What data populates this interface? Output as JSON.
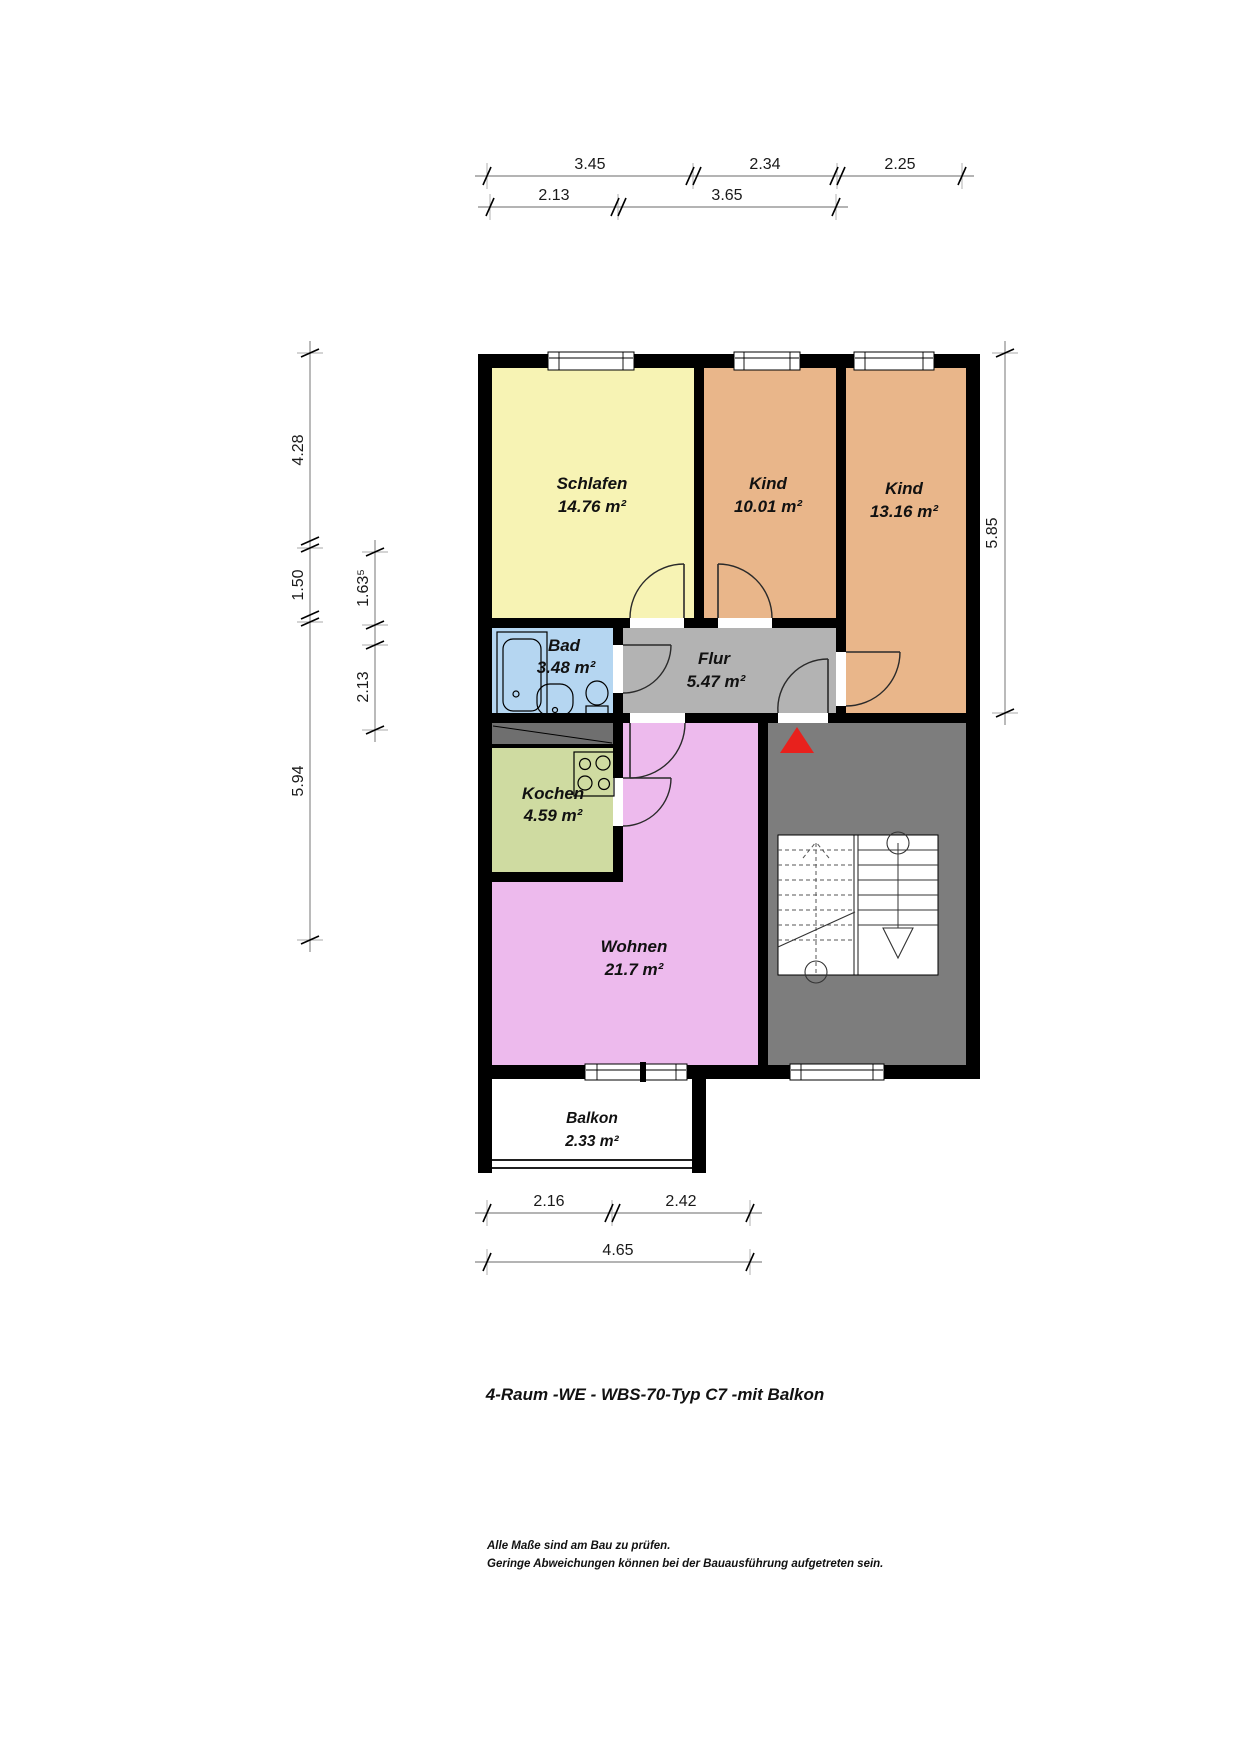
{
  "title": "4-Raum -WE - WBS-70-Typ C7 -mit Balkon",
  "notes": {
    "line1": "Alle Maße sind am Bau zu prüfen.",
    "line2": "Geringe Abweichungen können bei der Bauausführung aufgetreten sein."
  },
  "rooms": [
    {
      "id": "schlafen",
      "name": "Schlafen",
      "area": "14.76 m²",
      "color": "#f7f3b4"
    },
    {
      "id": "kind-1",
      "name": "Kind",
      "area": "10.01 m²",
      "color": "#e9b68a"
    },
    {
      "id": "kind-2",
      "name": "Kind",
      "area": "13.16 m²",
      "color": "#e9b68a"
    },
    {
      "id": "bad",
      "name": "Bad",
      "area": "3.48 m²",
      "color": "#b5d6f1"
    },
    {
      "id": "flur",
      "name": "Flur",
      "area": "5.47 m²",
      "color": "#b3b3b3"
    },
    {
      "id": "kochen",
      "name": "Kochen",
      "area": "4.59 m²",
      "color": "#cfdba1"
    },
    {
      "id": "wohnen",
      "name": "Wohnen",
      "area": "21.7 m²",
      "color": "#edbaed"
    },
    {
      "id": "balkon",
      "name": "Balkon",
      "area": "2.33 m²",
      "color": "#ffffff"
    }
  ],
  "dimensions": {
    "top_row1": [
      "3.45",
      "2.34",
      "2.25"
    ],
    "top_row2": [
      "2.13",
      "3.65"
    ],
    "left_outer": [
      "4.28",
      "1.50",
      "5.94"
    ],
    "left_inner": [
      "1.63⁵",
      "2.13"
    ],
    "right": [
      "5.85"
    ],
    "bottom_row1": [
      "2.16",
      "2.42"
    ],
    "bottom_row2": [
      "4.65"
    ]
  },
  "colors": {
    "wall": "#000000",
    "stairwell": "#7d7d7d",
    "shaft": "#6f6f6f",
    "entrance_arrow": "#e8211d"
  }
}
